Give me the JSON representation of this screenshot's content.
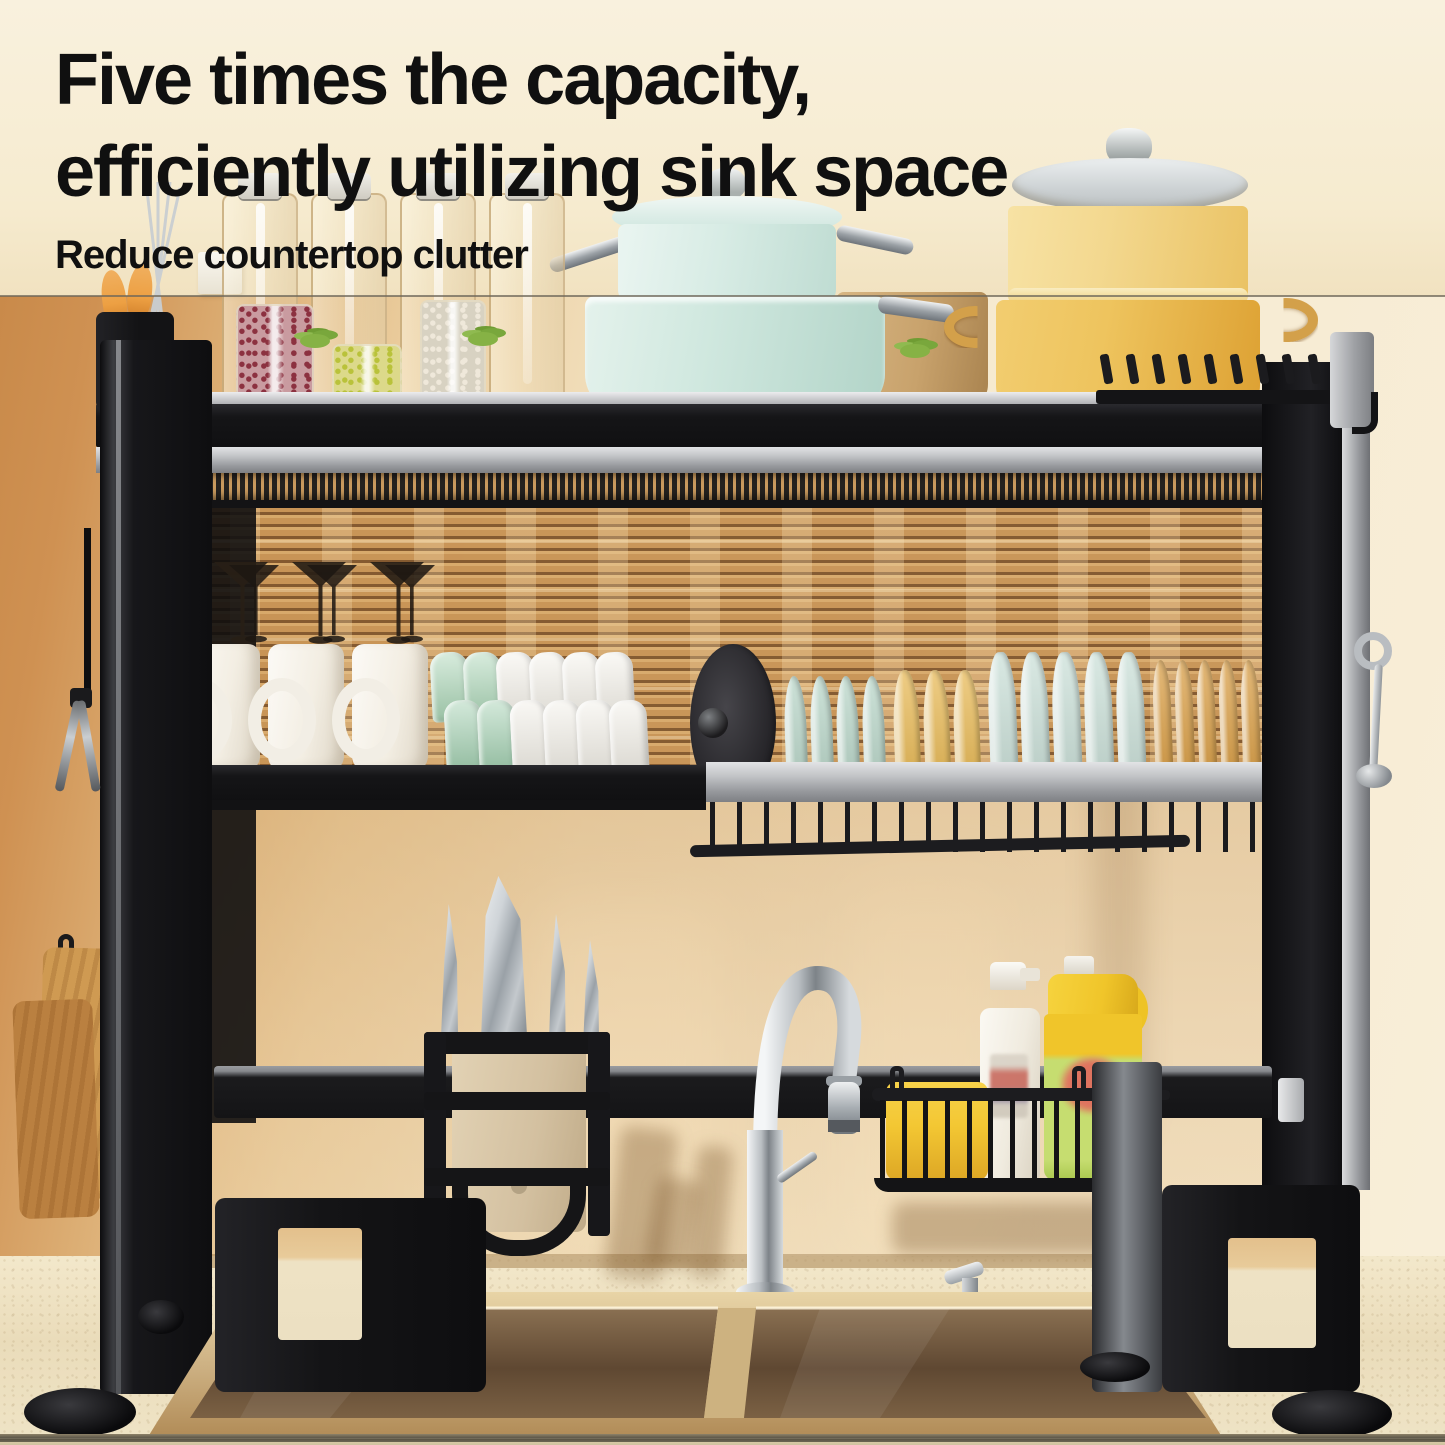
{
  "header": {
    "title_line1": "Five times the capacity,",
    "title_line2": "efficiently utilizing sink space",
    "subtitle": "Reduce countertop clutter"
  },
  "colors": {
    "title_black": "#101010",
    "wall_tan": "#cf9455",
    "wall_cream": "#f7edd6",
    "glass_amber": "#d3a368",
    "blind_slat": "#c79253",
    "rack_black": "#17171a",
    "rail_silver": "#c7c9cc",
    "counter": "#eee2c4",
    "sink_gold": "#d7bd8e",
    "sink_basin": "#6e543a",
    "mint_pot": "#d6ebe2",
    "yellow_pot": "#eec45e",
    "tan_pot": "#c8a26c",
    "mug_white": "#f7f4ee",
    "bowl_green": "#a9d5b5",
    "wood": "#c6924d",
    "sponge": "#f3c733",
    "jug_yellow": "#f0c52a",
    "jug_green": "#c6dd70",
    "label_red": "#e2685e",
    "handle_orange": "#eda043",
    "steel_dark": "#7d8388"
  },
  "scene": {
    "wine_glass_count": 3,
    "mug_count": 3,
    "bowl_rows": [
      [
        "#a9d5b5",
        "#a9d5b5",
        "#f4f1e9",
        "#f4f1e9",
        "#f4f1e9",
        "#f4f1e9"
      ],
      [
        "#9fceae",
        "#9fceae",
        "#f2efe7",
        "#f2efe7",
        "#f2efe7",
        "#f2efe7"
      ]
    ],
    "plate_groups": [
      {
        "name": "pot-lid",
        "color": "#323135",
        "count": 1
      },
      {
        "name": "teal-plates",
        "color": "#b7d5c7",
        "count": 4
      },
      {
        "name": "yellow-plates",
        "color": "#e7b750",
        "count": 3
      },
      {
        "name": "blue-plates",
        "color": "#c9dfd7",
        "count": 5
      },
      {
        "name": "orange-plates",
        "color": "#d89b3f",
        "count": 6
      }
    ],
    "back_jar_count": 4,
    "front_jars": [
      {
        "bean": "#8c3140",
        "base": "#c99ba0"
      },
      {
        "bean": "#b9c23a",
        "base": "#dcd98a"
      },
      {
        "bean": "#efe8da",
        "base": "#d8d2c2"
      }
    ],
    "knife_count": 4,
    "basket_wire_count": 11,
    "peg_count": 9
  }
}
